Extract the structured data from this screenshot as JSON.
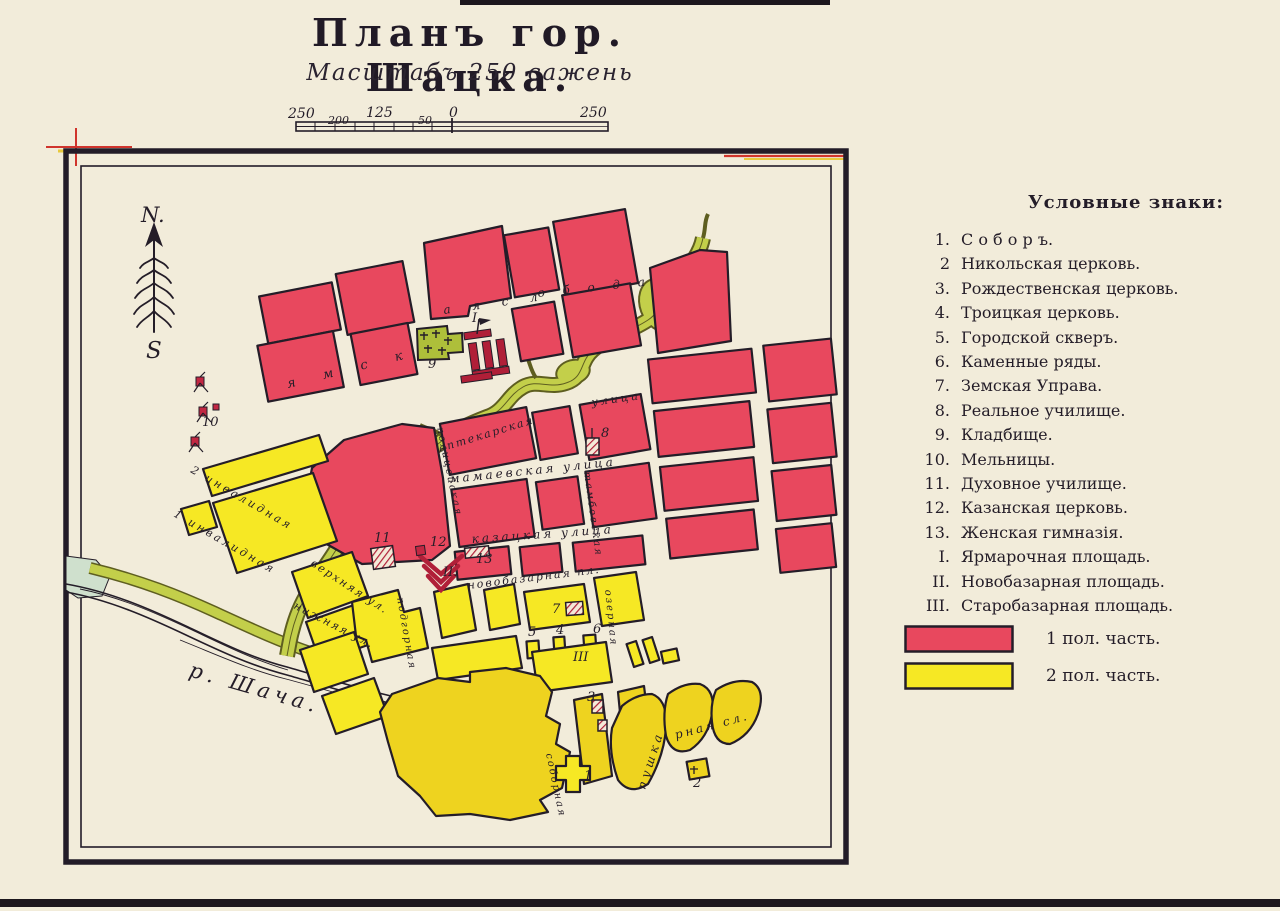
{
  "page": {
    "title": "Планъ гор. Шацка.",
    "subtitle": "Масштабъ 250 сажень"
  },
  "scalebar": {
    "labels": [
      "250",
      "200",
      "125",
      "50",
      "0",
      "250"
    ]
  },
  "compass": {
    "north": "N.",
    "south": "S"
  },
  "map": {
    "river_label": "р. Шача.",
    "street_labels": [
      {
        "text": "я м с к"
      },
      {
        "text": "а я   с л"
      },
      {
        "text": "о б   о д а"
      },
      {
        "text": "аптекарская"
      },
      {
        "text": "улица"
      },
      {
        "text": "мамаевская  улица"
      },
      {
        "text": "казацкая  улица"
      },
      {
        "text": "новобазарная  пл."
      },
      {
        "text": "полицейская"
      },
      {
        "text": "тамбовская"
      },
      {
        "text": "верхняя ул."
      },
      {
        "text": "нижняя ул."
      },
      {
        "text": "подгорная"
      },
      {
        "text": "озерная"
      },
      {
        "text": "2  инвалидная"
      },
      {
        "text": "1  инвалидная"
      },
      {
        "text": "пушка"
      },
      {
        "text": "рная  сл."
      },
      {
        "text": "соборная"
      }
    ],
    "numbers": [
      {
        "text": "I."
      },
      {
        "text": "9"
      },
      {
        "text": "10"
      },
      {
        "text": "11"
      },
      {
        "text": "12"
      },
      {
        "text": "13"
      },
      {
        "text": "II."
      },
      {
        "text": "7"
      },
      {
        "text": "5"
      },
      {
        "text": "4"
      },
      {
        "text": "6"
      },
      {
        "text": "III"
      },
      {
        "text": "8"
      },
      {
        "text": "3"
      },
      {
        "text": "1"
      },
      {
        "text": "2"
      }
    ]
  },
  "legend": {
    "header": "Условные знаки:",
    "items": [
      {
        "num": "1.",
        "label": "С о б о р ъ."
      },
      {
        "num": "2",
        "label": "Никольская церковь."
      },
      {
        "num": "3.",
        "label": "Рождественская церковь."
      },
      {
        "num": "4.",
        "label": "Троицкая церковь."
      },
      {
        "num": "5.",
        "label": "Городской скверъ."
      },
      {
        "num": "6.",
        "label": "Каменные ряды."
      },
      {
        "num": "7.",
        "label": "Земская Управа."
      },
      {
        "num": "8.",
        "label": "Реальное училище."
      },
      {
        "num": "9.",
        "label": "Кладбище."
      },
      {
        "num": "10.",
        "label": "Мельницы."
      },
      {
        "num": "11.",
        "label": "Духовное училище."
      },
      {
        "num": "12.",
        "label": "Казанская церковь."
      },
      {
        "num": "13.",
        "label": "Женская гимназія."
      },
      {
        "num": "I.",
        "label": "Ярмарочная площадь."
      },
      {
        "num": "II.",
        "label": "Новобазарная площадь."
      },
      {
        "num": "III.",
        "label": "Старобазарная площадь."
      }
    ],
    "swatches": [
      {
        "color": "#e8485e",
        "label": "1 пол. часть."
      },
      {
        "color": "#f6e824",
        "label": "2 пол. часть."
      }
    ]
  },
  "colors": {
    "paper": "#f2ecda",
    "ink": "#241d28",
    "part1_red": "#e8485e",
    "dark_red": "#b01f38",
    "part2_yellow": "#f6e824",
    "part2_gold": "#eed31f",
    "river_green": "#c3cf4a",
    "cemetery_green": "#aebf3a",
    "registration_red": "#d0342c",
    "registration_yellow": "#e8c93c"
  }
}
